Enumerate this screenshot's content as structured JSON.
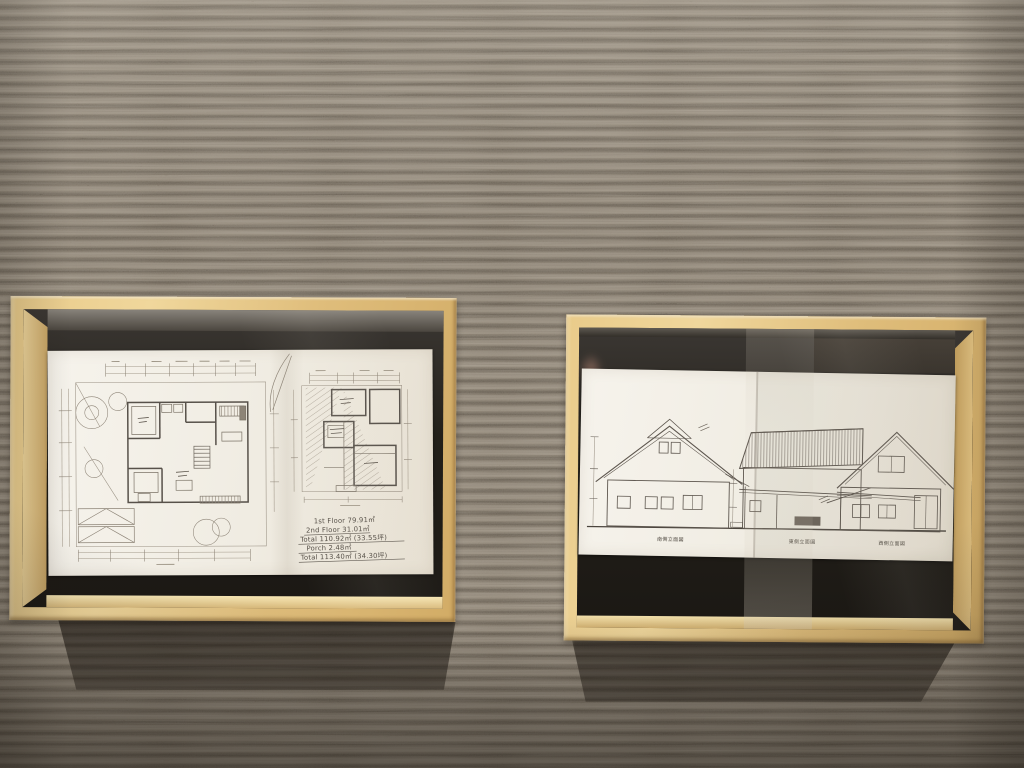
{
  "scene": {
    "description": "Two light-oak box frames with hand-drawn architectural sketches hung on a ridged gray carpet wall",
    "colors": {
      "wall_light": "#8e8476",
      "wall_dark": "#5a5145",
      "frame_wood": "#e0bd7c",
      "paper": "#f1ede3",
      "pencil": "#57514a",
      "shadow": "rgba(22,17,12,0.6)"
    }
  },
  "left_frame": {
    "title": "floor-plan-sketch",
    "area_table": [
      "1st Floor   79.91㎡",
      "2nd Floor   31.01㎡",
      "Total   110.92㎡ (33.55坪)",
      "Porch   2.48㎡",
      "Total   113.40㎡ (34.30坪)"
    ]
  },
  "right_frame": {
    "title": "elevation-sketches",
    "captions": [
      "南側立面図",
      "東側立面図",
      "西側立面図"
    ]
  }
}
